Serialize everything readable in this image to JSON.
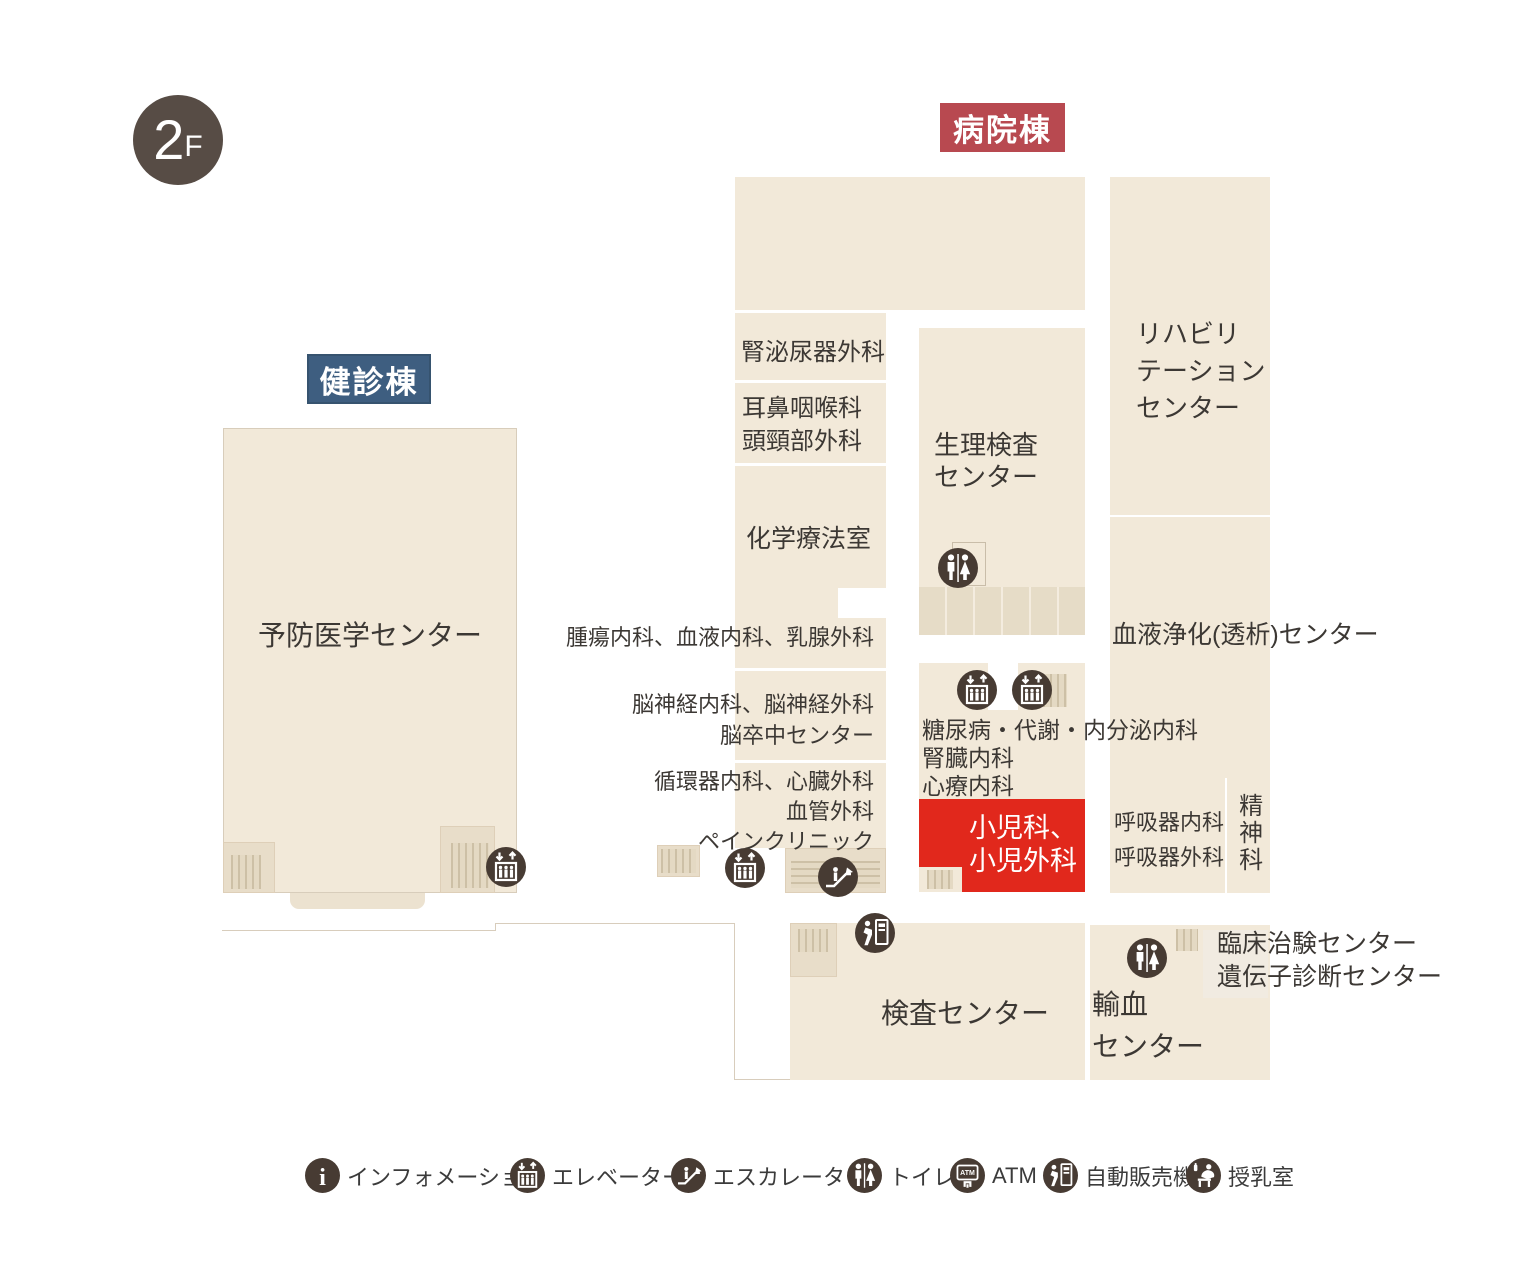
{
  "floor": {
    "badge_number": "2",
    "badge_suffix": "F"
  },
  "buildings": {
    "hospital_label": "病院棟",
    "checkup_label": "健診棟"
  },
  "rooms": {
    "urology": "腎泌尿器外科",
    "ent": "耳鼻咽喉科\n頭頸部外科",
    "chemotherapy": "化学療法室",
    "oncology": "腫瘍内科、血液内科、乳腺外科",
    "neurology": "脳神経内科、脳神経外科\n脳卒中センター",
    "cardiology": "循環器内科、心臓外科\n血管外科\nペインクリニック",
    "physio_exam": "生理検査\nセンター",
    "rehabilitation": "リハビリ\nテーション\nセンター",
    "dialysis": "血液浄化(透析)センター",
    "diabetes": "糖尿病・代謝・内分泌内科\n腎臓内科\n心療内科",
    "pediatrics": "小児科、\n小児外科",
    "respiratory": "呼吸器内科\n呼吸器外科",
    "psychiatry": "精神科",
    "clinical_trial": "臨床治験センター\n遺伝子診断センター",
    "test_center": "検査センター",
    "blood_transfusion": "輸血\nセンター",
    "preventive_medicine": "予防医学センター"
  },
  "legend": {
    "items": [
      {
        "icon": "information-icon",
        "label": "インフォメーション"
      },
      {
        "icon": "elevator-icon",
        "label": "エレベーター"
      },
      {
        "icon": "escalator-icon",
        "label": "エスカレーター"
      },
      {
        "icon": "toilet-icon",
        "label": "トイレ"
      },
      {
        "icon": "atm-icon",
        "label": "ATM"
      },
      {
        "icon": "vending-machine-icon",
        "label": "自動販売機"
      },
      {
        "icon": "nursing-room-icon",
        "label": "授乳室"
      }
    ]
  },
  "colors": {
    "floor_beige": "#f2e9d9",
    "highlight_red": "#e1281c",
    "hospital_label_bg": "#b84950",
    "checkup_label_bg": "#3e5e80",
    "icon_brown": "#473b33",
    "badge_gray": "#574c45"
  }
}
